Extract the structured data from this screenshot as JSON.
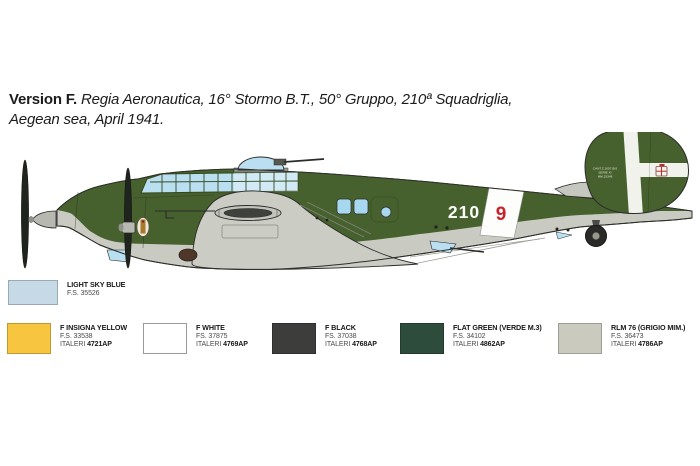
{
  "caption": {
    "version_label": "Version F.",
    "line1_rest": "Regia Aeronautica, 16° Stormo B.T., 50° Gruppo, 210ª Squadriglia,",
    "line2": "Aegean sea, April 1941."
  },
  "aircraft": {
    "fuselage_code": "210",
    "squadriglia_number": "9",
    "fin_stencil_lines": [
      "CANT.Z.1007 BIS",
      "SERIE XI",
      "MM.23348"
    ],
    "colors": {
      "upper_camouflage_green": "#47612e",
      "lower_surfaces_grey": "#c9cac2",
      "glazing_blue": "#b9dff1",
      "band_white": "#fdfdfb",
      "code_red": "#c8232b",
      "propeller_black": "#20241e"
    }
  },
  "paint_swatches": [
    {
      "name": "LIGHT SKY BLUE",
      "fs": "F.S. 35526",
      "italeri_label": "",
      "italeri_code": "",
      "hex": "#c6d9e7"
    },
    {
      "name": "F INSIGNA YELLOW",
      "fs": "F.S. 33538",
      "italeri_label": "ITALERI",
      "italeri_code": "4721AP",
      "hex": "#f8c540"
    },
    {
      "name": "F WHITE",
      "fs": "FS. 37875",
      "italeri_label": "ITALERI",
      "italeri_code": "4769AP",
      "hex": "#ffffff"
    },
    {
      "name": "F BLACK",
      "fs": "FS. 37038",
      "italeri_label": "ITALERI",
      "italeri_code": "4768AP",
      "hex": "#3d3d3b"
    },
    {
      "name": "FLAT GREEN (VERDE M.3)",
      "fs": "F.S. 34102",
      "italeri_label": "ITALERI",
      "italeri_code": "4862AP",
      "hex": "#2e4c3c"
    },
    {
      "name": "RLM 76 (GRIGIO MIM.)",
      "fs": "F.S. 36473",
      "italeri_label": "ITALERI",
      "italeri_code": "4786AP",
      "hex": "#cbcabf"
    }
  ]
}
